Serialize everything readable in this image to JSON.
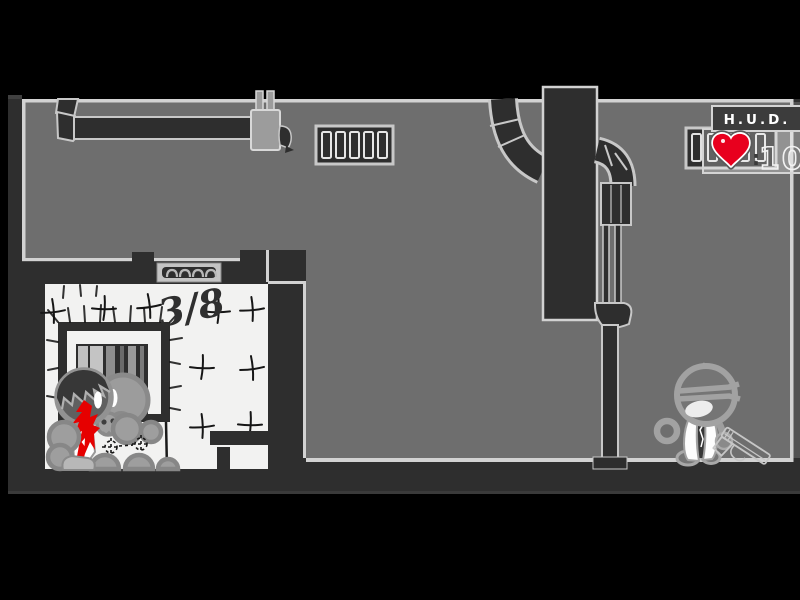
{
  "hud": {
    "title": "H.U.D.",
    "separator": ":",
    "health": "100"
  },
  "room": {
    "counter": "3/8"
  },
  "colors": {
    "blood": "#e60000",
    "heart": "#e8001e",
    "wall": "#6e6e6e",
    "dark": "#2e2e2e",
    "outline": "#d2d2d2",
    "room_white": "#f2f2f1",
    "hud_title_bg": "#3c3c3c",
    "black": "#000000"
  }
}
